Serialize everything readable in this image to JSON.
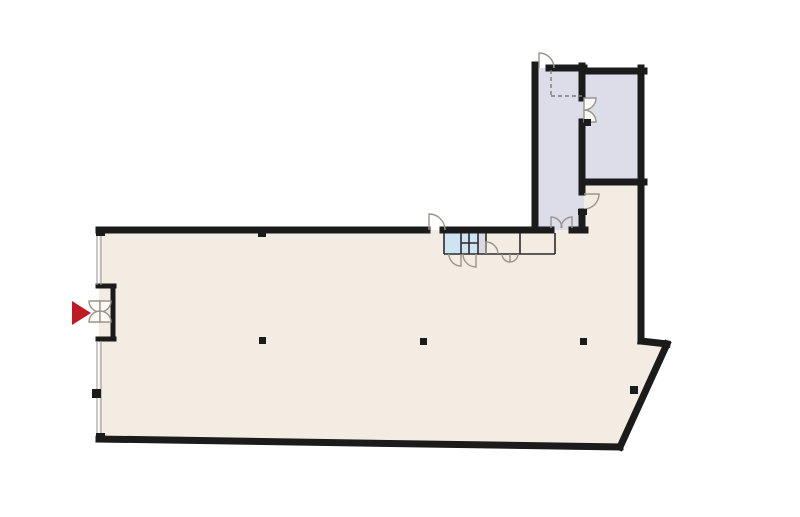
{
  "canvas": {
    "width": 800,
    "height": 517,
    "background": "#ffffff"
  },
  "palette": {
    "wall": "#1b1b1b",
    "hall": "#f2ece2",
    "room": "#dcdde8",
    "wet": "#cfe4f3",
    "grayroom": "#d8d9e2",
    "door_stroke": "#9a948c",
    "door_fill": "#fbfaf7",
    "window_line": "#9a9a9a",
    "thin_line": "#2b2b2b",
    "dashed_line": "#7d7d7d",
    "arrow": "#bf1a24"
  },
  "regions": [
    {
      "name": "main-hall",
      "fill": "hall",
      "points": [
        [
          99,
          230
        ],
        [
          582,
          230
        ],
        [
          582,
          184
        ],
        [
          641,
          184
        ],
        [
          641,
          341
        ],
        [
          667,
          344
        ],
        [
          620,
          447
        ],
        [
          99,
          439
        ]
      ]
    },
    {
      "name": "room-upper-left",
      "fill": "room",
      "points": [
        [
          535,
          68
        ],
        [
          584,
          68
        ],
        [
          584,
          230
        ],
        [
          535,
          230
        ]
      ]
    },
    {
      "name": "room-upper-right",
      "fill": "room",
      "points": [
        [
          582,
          71
        ],
        [
          643,
          71
        ],
        [
          643,
          182
        ],
        [
          582,
          182
        ]
      ]
    },
    {
      "name": "cabin-blue-left",
      "fill": "wet",
      "points": [
        [
          444,
          233
        ],
        [
          461,
          233
        ],
        [
          461,
          254
        ],
        [
          444,
          254
        ]
      ]
    },
    {
      "name": "cabin-blue-right",
      "fill": "wet",
      "points": [
        [
          461,
          233
        ],
        [
          478,
          233
        ],
        [
          478,
          254
        ],
        [
          461,
          254
        ]
      ]
    },
    {
      "name": "cabin-gray",
      "fill": "grayroom",
      "points": [
        [
          478,
          233
        ],
        [
          486,
          233
        ],
        [
          486,
          254
        ],
        [
          478,
          254
        ]
      ]
    },
    {
      "name": "cabin-white-left",
      "fill": "hall",
      "points": [
        [
          486,
          233
        ],
        [
          520,
          233
        ],
        [
          520,
          254
        ],
        [
          486,
          254
        ]
      ]
    },
    {
      "name": "cabin-white-right",
      "fill": "hall",
      "points": [
        [
          520,
          233
        ],
        [
          555,
          233
        ],
        [
          555,
          254
        ],
        [
          520,
          254
        ]
      ]
    }
  ],
  "wall_groups": [
    {
      "name": "exterior-and-structural-walls",
      "stroke": "wall",
      "width": 7,
      "cap": "square",
      "segments": [
        [
          99,
          230,
          427,
          230
        ],
        [
          443,
          230,
          551,
          230
        ],
        [
          572,
          230,
          585,
          230
        ],
        [
          535,
          65,
          535,
          230
        ],
        [
          549,
          68,
          584,
          68
        ],
        [
          582,
          66,
          582,
          98
        ],
        [
          582,
          122,
          582,
          192
        ],
        [
          582,
          212,
          582,
          230
        ],
        [
          582,
          71,
          644,
          71
        ],
        [
          641,
          68,
          641,
          341
        ],
        [
          582,
          182,
          644,
          182
        ],
        [
          641,
          341,
          667,
          344
        ],
        [
          667,
          344,
          620,
          447
        ],
        [
          620,
          447,
          99,
          439
        ]
      ]
    },
    {
      "name": "entrance-vestibule-frame",
      "stroke": "wall",
      "width": 5,
      "cap": "square",
      "segments": [
        [
          98,
          286,
          114,
          286
        ],
        [
          113,
          286,
          113,
          339
        ],
        [
          98,
          339,
          114,
          339
        ]
      ]
    },
    {
      "name": "cabin-partitions",
      "stroke": "thin_line",
      "width": 1.6,
      "cap": "butt",
      "segments": [
        [
          444,
          254,
          555,
          254
        ],
        [
          444,
          233,
          444,
          254
        ],
        [
          461,
          233,
          461,
          254
        ],
        [
          478,
          233,
          478,
          254
        ],
        [
          486,
          233,
          486,
          254
        ],
        [
          520,
          233,
          520,
          254
        ],
        [
          555,
          233,
          555,
          254
        ],
        [
          461,
          243,
          478,
          243
        ],
        [
          469,
          233,
          469,
          254
        ]
      ]
    },
    {
      "name": "glazed-facade-lines",
      "stroke": "window_line",
      "width": 1.1,
      "cap": "butt",
      "segments": [
        [
          97,
          233,
          97,
          285
        ],
        [
          101,
          233,
          101,
          285
        ],
        [
          97,
          341,
          97,
          435
        ],
        [
          101,
          341,
          101,
          435
        ]
      ]
    },
    {
      "name": "overhead-dashed-lines",
      "stroke": "dashed_line",
      "width": 1.4,
      "cap": "butt",
      "dash": "4 3",
      "segments": [
        [
          551,
          70,
          551,
          96
        ],
        [
          551,
          96,
          582,
          96
        ]
      ]
    }
  ],
  "doors": [
    {
      "name": "door-hall-top-exit",
      "d": "M429 230 L429 214 A16 16 0 0 1 445 230",
      "fill": "none"
    },
    {
      "name": "door-room-upper-left-top",
      "d": "M539 68 L539 53 A15 15 0 0 1 554 68",
      "fill": "none"
    },
    {
      "name": "door-between-upper-rooms-leaf-a",
      "d": "M584 98 L596 98 A12 12 0 0 1 584 110 Z",
      "fill": "door"
    },
    {
      "name": "door-between-upper-rooms-leaf-b",
      "d": "M584 122 L596 122 A12 12 0 0 0 584 110 Z",
      "fill": "door"
    },
    {
      "name": "door-room-to-arm",
      "d": "M584 194 L599 194 A15 15 0 0 1 584 209",
      "fill": "none"
    },
    {
      "name": "door-room-bottom-double-leaf-a",
      "d": "M551 228 L551 217 A11 11 0 0 1 562 228",
      "fill": "none"
    },
    {
      "name": "door-room-bottom-double-leaf-b",
      "d": "M572 228 L572 217 A11 11 0 0 0 561 228",
      "fill": "none"
    },
    {
      "name": "door-cabin-white-inner",
      "d": "M486 254 L486 242 A12 12 0 0 1 498 254",
      "fill": "none"
    },
    {
      "name": "door-cabin-blue-left",
      "d": "M461 254 L461 266 A12 12 0 0 1 449 254",
      "fill": "none"
    },
    {
      "name": "door-cabin-blue-right",
      "d": "M476 254 L476 267 A13 13 0 0 1 463 254",
      "fill": "none"
    },
    {
      "name": "door-cabin-white-double",
      "d": "M502 254 A8 8 0 0 0 518 254 M510 254 L510 262",
      "fill": "none"
    },
    {
      "name": "door-entrance-leaf-out-top",
      "d": "M100 301 L89 301 A11 11 0 0 0 100 312 Z",
      "fill": "door"
    },
    {
      "name": "door-entrance-leaf-out-bottom",
      "d": "M100 322 L89 322 A11 11 0 0 1 100 311 Z",
      "fill": "door"
    },
    {
      "name": "door-entrance-leaf-in-top",
      "d": "M100 301 L111 301 A11 11 0 0 1 100 312 Z",
      "fill": "door"
    },
    {
      "name": "door-entrance-leaf-in-bottom",
      "d": "M100 322 L111 322 A11 11 0 0 0 100 311 Z",
      "fill": "door"
    }
  ],
  "columns": [
    {
      "name": "column-hall-left",
      "rect": [
        259,
        337,
        7,
        7
      ]
    },
    {
      "name": "column-hall-center",
      "rect": [
        420,
        338,
        7,
        7
      ]
    },
    {
      "name": "column-hall-right",
      "rect": [
        580,
        338,
        7,
        7
      ]
    },
    {
      "name": "column-top-wall",
      "rect": [
        258,
        231,
        8,
        6
      ]
    },
    {
      "name": "column-facade-left",
      "rect": [
        92,
        389,
        9,
        9
      ]
    },
    {
      "name": "corner-top-left",
      "rect": [
        96,
        228,
        9,
        8
      ]
    },
    {
      "name": "corner-bottom-left",
      "rect": [
        96,
        433,
        9,
        8
      ]
    },
    {
      "name": "wall-stop-upper-door",
      "rect": [
        584,
        119,
        7,
        7
      ]
    },
    {
      "name": "wall-stop-arm-door",
      "rect": [
        578,
        209,
        9,
        6
      ]
    },
    {
      "name": "diagonal-wall-notch",
      "rect": [
        630,
        386,
        8,
        8
      ]
    }
  ],
  "entrance_marker": {
    "name": "entrance-arrow",
    "points": [
      [
        72,
        301
      ],
      [
        72,
        325
      ],
      [
        91,
        313
      ]
    ],
    "fill": "arrow"
  }
}
